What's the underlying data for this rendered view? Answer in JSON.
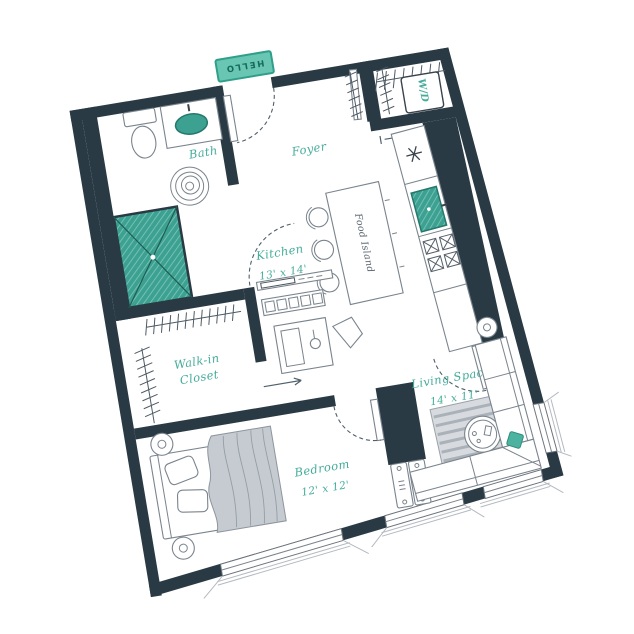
{
  "plan": {
    "type": "apartment-floor-plan",
    "mat": "HELLO",
    "rooms": {
      "foyer": "Foyer",
      "bath": "Bath",
      "closet_line1": "Walk-in",
      "closet_line2": "Closet",
      "kitchen": "Kitchen",
      "kitchen_dims": "13' x 14'",
      "island": "Food Island",
      "laundry": "W/D",
      "bedroom": "Bedroom",
      "bedroom_dims": "12' x 12'",
      "living": "Living Space",
      "living_dims": "14' x 11'"
    },
    "colors": {
      "wall": "#2a3a45",
      "label_teal": "#44ac9a",
      "fixture_teal": "#3da192",
      "mat_fill": "#68c6b3",
      "mat_border": "#2f9e8b",
      "accent_pillow": "#4db3a0",
      "blanket_gray": "#c6cbd1"
    }
  }
}
